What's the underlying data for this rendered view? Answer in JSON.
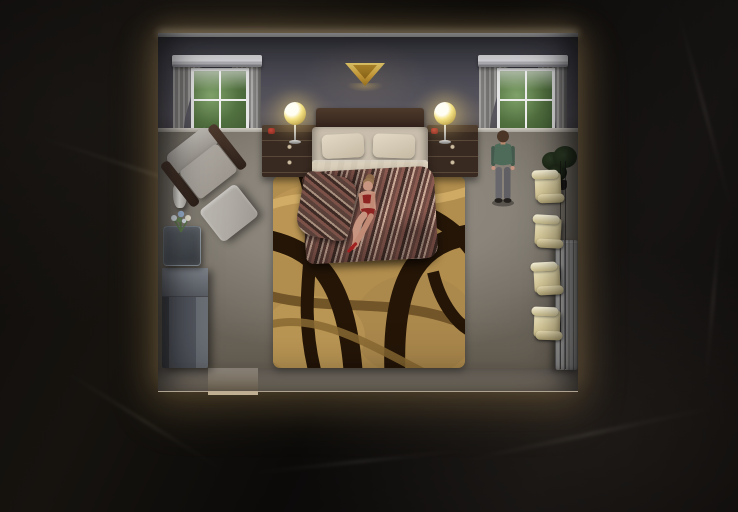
{
  "scene": {
    "view": "top-down dollhouse room view",
    "room_label": "bedroom at night",
    "characters": {
      "woman": {
        "label": "woman in red lingerie sitting on foot of bed"
      },
      "man": {
        "label": "man standing by the window"
      }
    },
    "objects": {
      "bed": {
        "label": "double bed with striped blanket"
      },
      "headboard": {
        "label": "wood headboard"
      },
      "window_left": {
        "label": "window with gray curtains"
      },
      "window_right": {
        "label": "window with gray curtains"
      },
      "sconce": {
        "label": "gold wall sconce"
      },
      "nightstand_left": {
        "label": "nightstand"
      },
      "nightstand_right": {
        "label": "nightstand"
      },
      "lamp_left": {
        "label": "table lamp, lit"
      },
      "lamp_right": {
        "label": "table lamp, lit"
      },
      "armchair": {
        "label": "gray armchair"
      },
      "ottoman": {
        "label": "ottoman"
      },
      "vase": {
        "label": "white floor vase"
      },
      "side_table": {
        "label": "glass side table"
      },
      "flowers": {
        "label": "flowers in vase"
      },
      "cabinet": {
        "label": "gray cabinet"
      },
      "rug": {
        "label": "tan rug with dark wave pattern"
      },
      "plant": {
        "label": "dark potted plant"
      },
      "radiator": {
        "label": "radiator"
      },
      "doorway": {
        "label": "doorway opening in bottom wall"
      }
    },
    "collectibles": {
      "icon": "scroll-icon",
      "count": 4,
      "label": "scroll note"
    }
  },
  "palette": {
    "glow": "#e9c087",
    "wall": "#55545e",
    "carpet": "#8b857c",
    "rug_base": "#b28e4e",
    "rug_dark": "#2b1a0c",
    "rug_light": "#d2ad6a",
    "bedding": "#d2c7b3",
    "blanket": "#7c4a44",
    "scroll": "#e9ddae",
    "lamp_glow": "#f2df7a",
    "curtain": "#8f8d8c",
    "foliage": "#5e7d4d",
    "sconce_gold": "#d1a844",
    "marble": "#0d0b0a",
    "skin": "#c89580",
    "man_shirt": "#4e6b5a",
    "man_pants": "#68676b",
    "hair_brown": "#4a3526",
    "woman_outfit": "#8e2422"
  }
}
